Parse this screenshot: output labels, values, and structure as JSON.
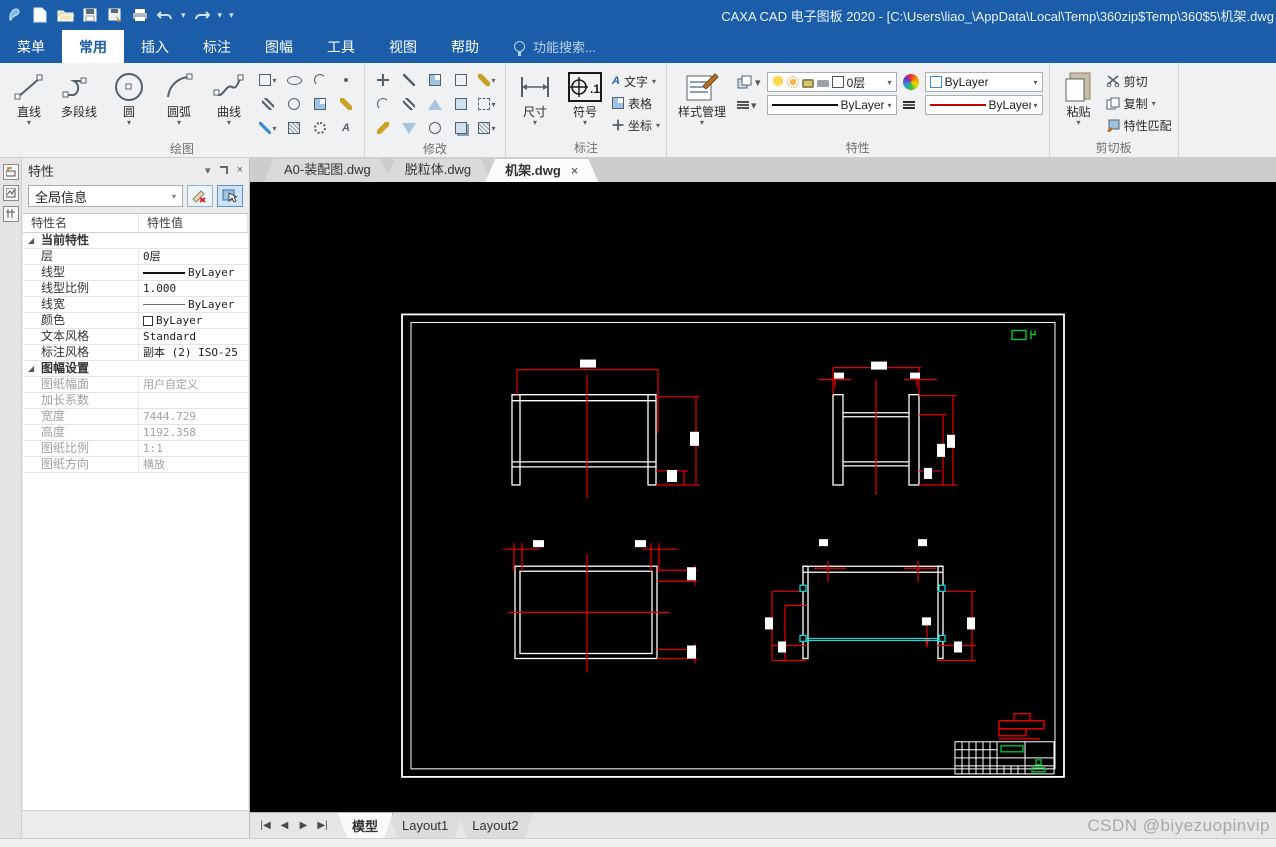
{
  "icons": {
    "dropdown": "▾",
    "close": "×",
    "collapse": "◢",
    "nav_first": "|◀",
    "nav_prev": "◀",
    "nav_next": "▶",
    "nav_last": "▶|"
  },
  "title_bar": {
    "app_title": "CAXA CAD 电子图板 2020 - [C:\\Users\\liao_\\AppData\\Local\\Temp\\360zip$Temp\\360$5\\机架.dwg"
  },
  "menu_bar": {
    "tabs": [
      "菜单",
      "常用",
      "插入",
      "标注",
      "图幅",
      "工具",
      "视图",
      "帮助"
    ],
    "active_tab": "常用",
    "search_placeholder": "功能搜索..."
  },
  "ribbon": {
    "draw_group": {
      "label": "绘图",
      "buttons": [
        "直线",
        "多段线",
        "圆",
        "圆弧",
        "曲线"
      ]
    },
    "modify_group": {
      "label": "修改"
    },
    "dim_group": {
      "label": "标注",
      "buttons": [
        "尺寸",
        "符号"
      ],
      "stack": [
        "文字",
        "表格",
        "坐标"
      ]
    },
    "props_group": {
      "label": "特性",
      "style_button": "样式管理",
      "layer_value": "0层",
      "color_value": "ByLayer",
      "linetype_value": "ByLayer",
      "lineweight_value": "ByLayer"
    },
    "clip_group": {
      "label": "剪切板",
      "paste_button": "粘贴",
      "items": [
        "剪切",
        "复制",
        "特性匹配"
      ]
    }
  },
  "doc_tabs": {
    "tabs": [
      "A0-装配图.dwg",
      "脱粒体.dwg",
      "机架.dwg"
    ],
    "active_tab": "机架.dwg"
  },
  "properties_panel": {
    "title": "特性",
    "selector_value": "全局信息",
    "col_name": "特性名",
    "col_value": "特性值",
    "rows": [
      {
        "type": "group",
        "name": "当前特性"
      },
      {
        "name": "层",
        "value": "0层"
      },
      {
        "name": "线型",
        "value": "ByLayer",
        "swatch": "line"
      },
      {
        "name": "线型比例",
        "value": "1.000"
      },
      {
        "name": "线宽",
        "value": "ByLayer",
        "swatch": "thinline"
      },
      {
        "name": "颜色",
        "value": "ByLayer",
        "swatch": "colorbox"
      },
      {
        "name": "文本风格",
        "value": "Standard"
      },
      {
        "name": "标注风格",
        "value": "副本 (2) ISO-25"
      },
      {
        "type": "group",
        "name": "图幅设置"
      },
      {
        "name": "图纸幅面",
        "value": "用户自定义",
        "disabled": true
      },
      {
        "name": "加长系数",
        "value": "",
        "disabled": true
      },
      {
        "name": "宽度",
        "value": "7444.729",
        "disabled": true
      },
      {
        "name": "高度",
        "value": "1192.358",
        "disabled": true
      },
      {
        "name": "图纸比例",
        "value": "1:1",
        "disabled": true
      },
      {
        "name": "图纸方向",
        "value": "横放",
        "disabled": true
      }
    ]
  },
  "layout_bar": {
    "tabs": [
      "模型",
      "Layout1",
      "Layout2"
    ],
    "active_tab": "模型"
  },
  "canvas": {
    "watermark": "CSDN @biyezuopinvip",
    "colors": {
      "cad_red": "#e80000",
      "cad_cyan": "#00e5e5",
      "cad_green": "#00cc33",
      "background": "#000000",
      "lines": "#ffffff"
    }
  }
}
